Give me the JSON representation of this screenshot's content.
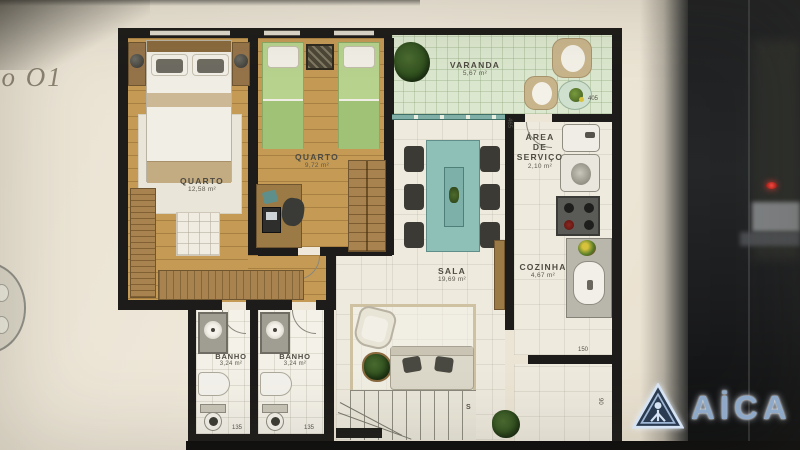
{
  "photo": {
    "corner_text": "po O1",
    "watermark_brand": "AICA",
    "watermark_display": "AİCA"
  },
  "rooms": {
    "quarto1": {
      "name": "QUARTO",
      "area": "12,58 m²"
    },
    "quarto2": {
      "name": "QUARTO",
      "area": "9,72 m²"
    },
    "varanda": {
      "name": "VARANDA",
      "area": "5,67 m²"
    },
    "servico": {
      "line1": "ÁREA",
      "line2": "DE",
      "line3": "SERVIÇO",
      "area": "2,10 m²"
    },
    "cozinha": {
      "name": "COZINHA",
      "area": "4,67 m²"
    },
    "sala": {
      "name": "SALA",
      "area": "19,69 m²"
    },
    "banho1": {
      "name": "BANHO",
      "area": "3,24 m²"
    },
    "banho2": {
      "name": "BANHO",
      "area": "3,24 m²"
    }
  },
  "dims": {
    "d405": "405",
    "d465": "465",
    "d150": "150",
    "d90": "90",
    "d135a": "135",
    "d135b": "135",
    "stairs": "S"
  },
  "colors": {
    "wall": "#1d1c1a",
    "wood_floor": "#c49a55",
    "varanda_floor": "#dbe7ce",
    "tile_floor": "#eeeade",
    "bed_green": "#b7d38e",
    "table_teal": "#8fc0b8",
    "logo_blue": "#8fa9c9"
  }
}
